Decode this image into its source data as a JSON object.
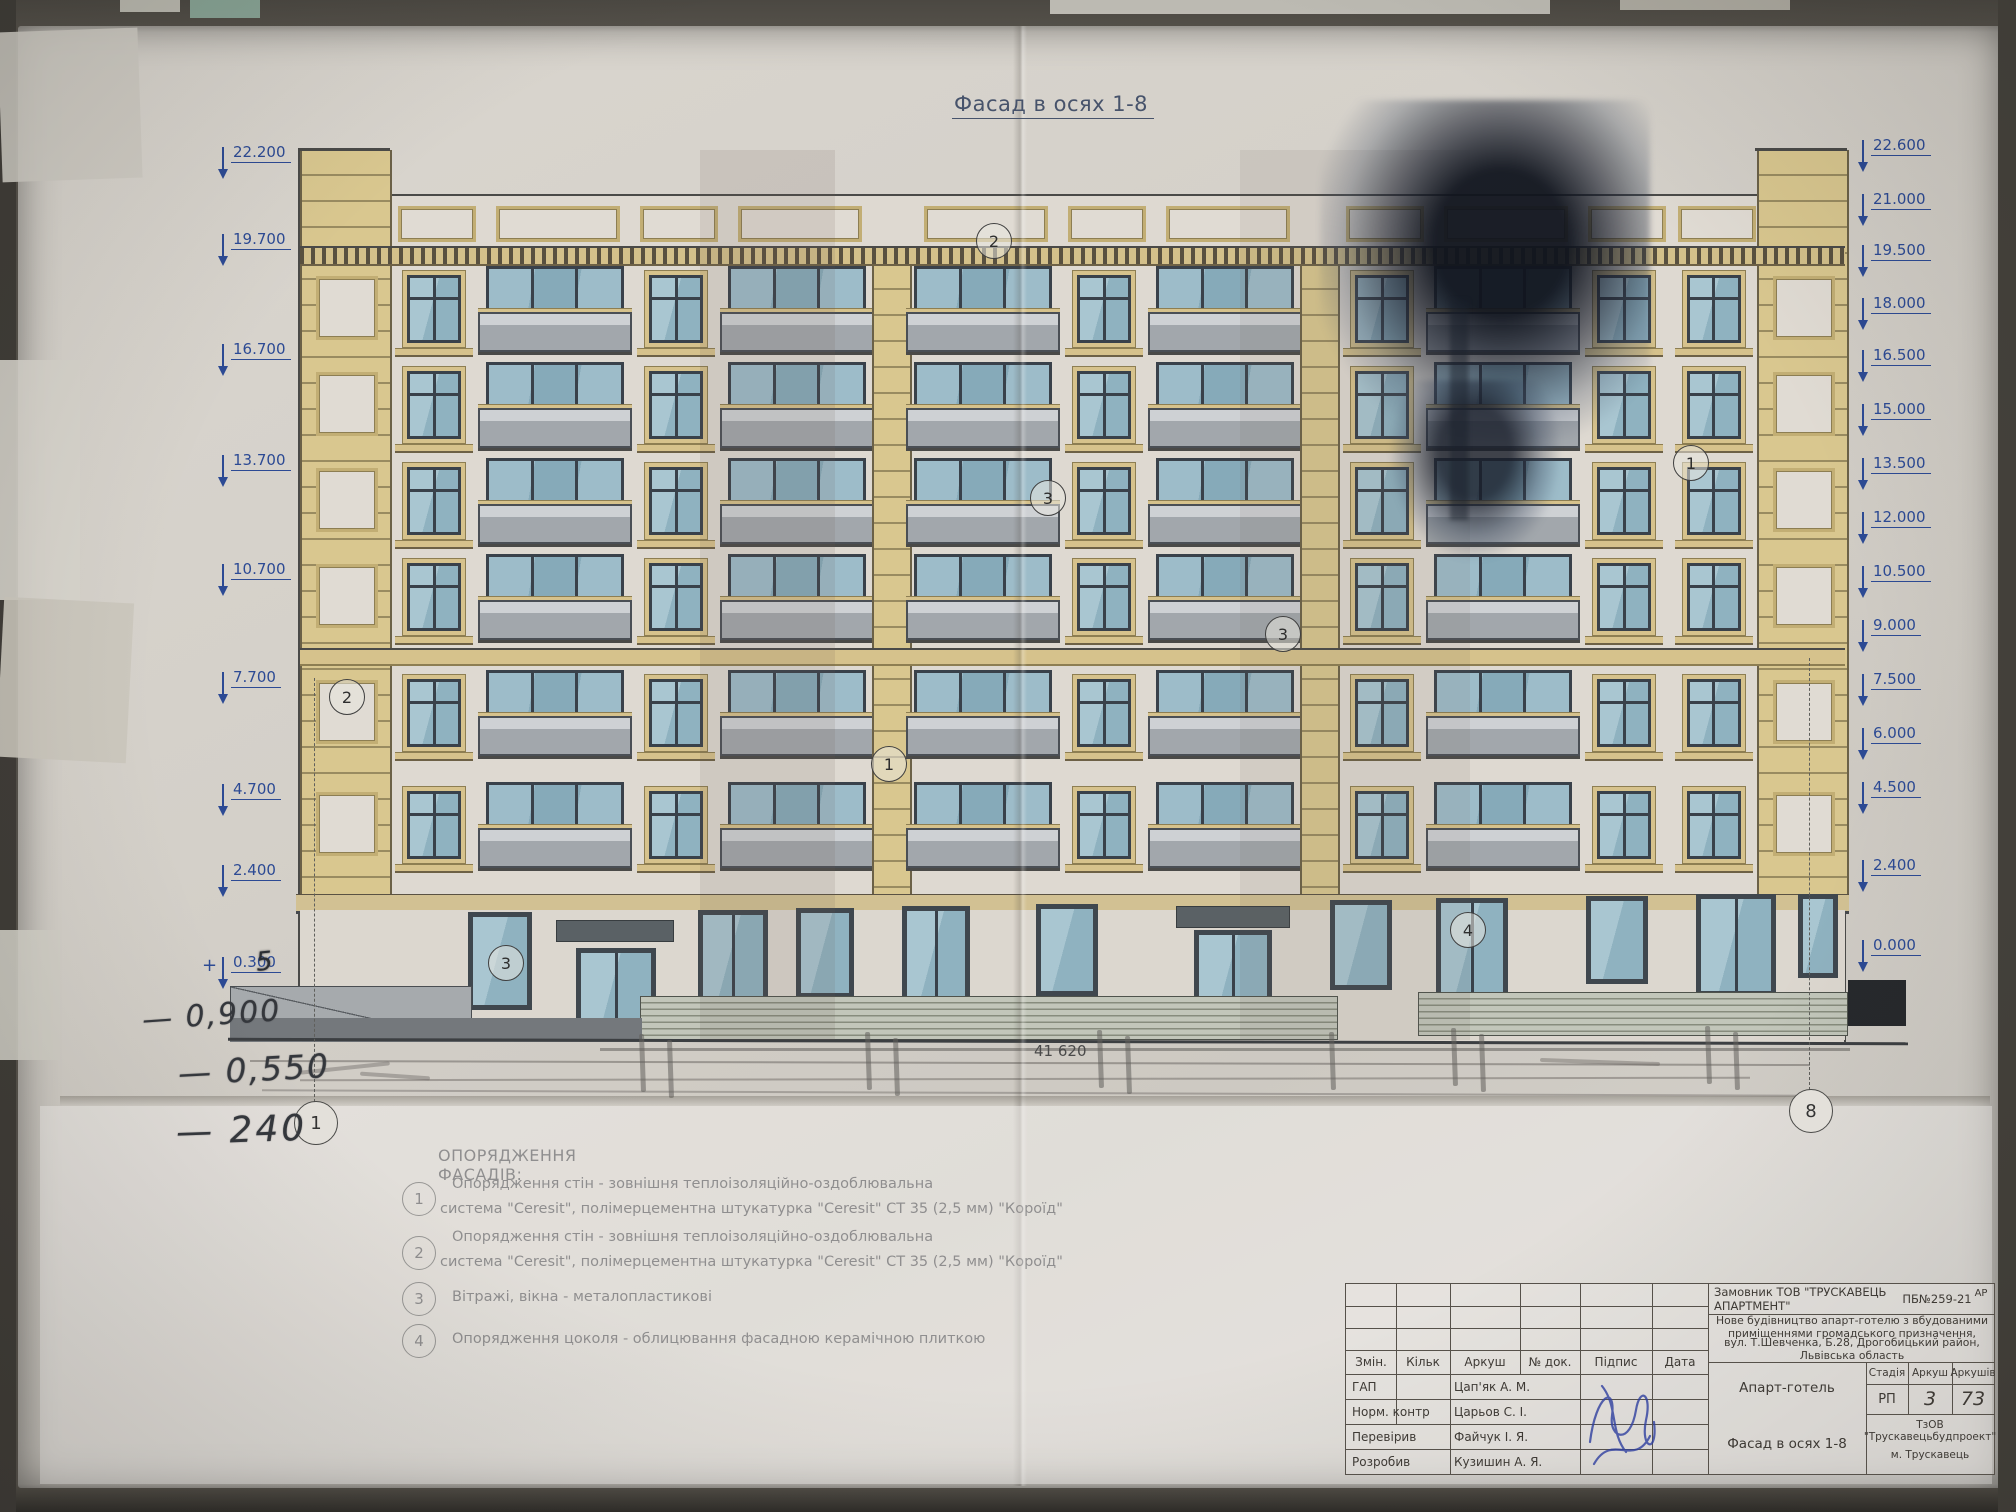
{
  "drawing": {
    "title": "Фасад в осях 1-8",
    "dimension_total": "41 620"
  },
  "elevation_marks": {
    "left": [
      "22.200",
      "19.700",
      "16.700",
      "13.700",
      "10.700",
      "7.700",
      "4.700",
      "2.400",
      "0.300"
    ],
    "right": [
      "22.600",
      "21.000",
      "19.500",
      "18.000",
      "16.500",
      "15.000",
      "13.500",
      "12.000",
      "10.500",
      "9.000",
      "7.500",
      "6.000",
      "4.500",
      "2.400",
      "0.000"
    ]
  },
  "annotations": {
    "plus_prefix": "+",
    "overlay_digit": "5",
    "hand1": "— 0,900",
    "hand2": "— 0,550",
    "hand3": "— 240"
  },
  "axis_bubbles": {
    "left": "1",
    "right": "8"
  },
  "facade_markers": [
    "2",
    "2",
    "3",
    "3",
    "1",
    "1",
    "3",
    "4"
  ],
  "legend": {
    "heading": "ОПОРЯДЖЕННЯ ФАСАДІВ:",
    "items": [
      {
        "num": "1",
        "line1": "Опорядження стін - зовнішня теплоізоляційно-оздоблювальна",
        "line2": "система \"Ceresit\", полімерцементна штукатурка \"Ceresit\" СТ 35 (2,5 мм) \"Короїд\""
      },
      {
        "num": "2",
        "line1": "Опорядження стін - зовнішня теплоізоляційно-оздоблювальна",
        "line2": "система \"Ceresit\", полімерцементна штукатурка \"Ceresit\" СТ 35 (2,5 мм) \"Короїд\""
      },
      {
        "num": "3",
        "line1": "Вітражі, вікна - металопластикові",
        "line2": ""
      },
      {
        "num": "4",
        "line1": "Опорядження цоколя - облицювання фасадною керамічною плиткою",
        "line2": ""
      }
    ]
  },
  "titleblock": {
    "customer": "Замовник  ТОВ \"ТРУСКАВЕЦЬ АПАРТМЕНТ\"",
    "doc_no": "ПБ№259-21",
    "corner_code": "АР",
    "description_line1": "Нове будівництво апарт-готелю з вбудованими приміщеннями громадського призначення,",
    "description_line2": "вул. Т.Шевченка, Б.28, Дрогобицький район, Львівська область",
    "object_name": "Апарт-готель",
    "sheet_name": "Фасад в осях 1-8",
    "columns": [
      "Змін.",
      "Кільк",
      "Аркуш",
      "№ док.",
      "Підпис",
      "Дата"
    ],
    "stage_label": "Стадія",
    "sheet_label": "Аркуш",
    "sheets_label": "Аркушів",
    "stage": "РП",
    "sheet_no": "3",
    "sheets_total": "73",
    "roles": [
      {
        "role": "ГАП",
        "name": "Цап'як А. М."
      },
      {
        "role": "Норм. контр",
        "name": "Царьов С. І."
      },
      {
        "role": "Перевірив",
        "name": "Файчук І. Я."
      },
      {
        "role": "Розробив",
        "name": "Кузишин А. Я."
      }
    ],
    "firm_line1": "ТзОВ \"Трускавецьбудпроект\"",
    "firm_line2": "м. Трускавець"
  }
}
